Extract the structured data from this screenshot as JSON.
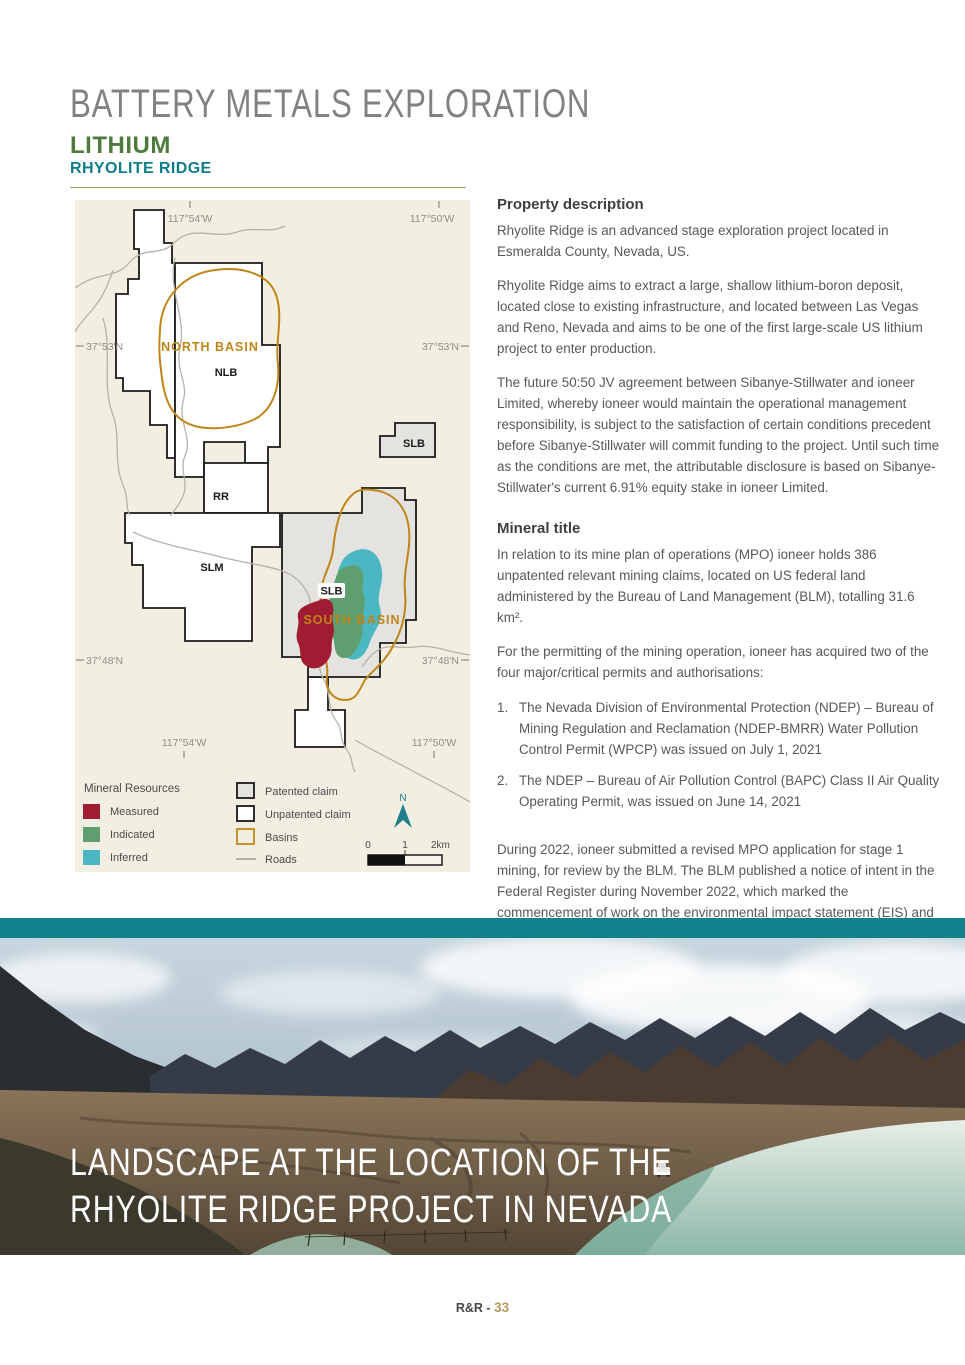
{
  "header": {
    "title": "BATTERY METALS EXPLORATION",
    "commodity": "LITHIUM",
    "project": "RHYOLITE RIDGE"
  },
  "property_description": {
    "heading": "Property description",
    "p1": "Rhyolite Ridge is an advanced stage exploration project located in Esmeralda County, Nevada, US.",
    "p2": "Rhyolite Ridge aims to extract a large, shallow lithium-boron deposit, located close to existing infrastructure, and located between Las Vegas and Reno, Nevada and aims to be one of the first large-scale US lithium project to enter production.",
    "p3": "The future 50:50 JV agreement between Sibanye-Stillwater and ioneer Limited, whereby ioneer would maintain the operational management responsibility, is subject to the satisfaction of certain conditions precedent before Sibanye-Stillwater will commit funding to the project. Until such time as the conditions are met, the attributable disclosure is based on Sibanye-Stillwater's current 6.91% equity stake in ioneer Limited."
  },
  "mineral_title": {
    "heading": "Mineral title",
    "p1": "In relation to its mine plan of operations (MPO) ioneer holds 386 unpatented relevant mining claims, located on US federal land administered by the Bureau of Land Management (BLM), totalling 31.6 km².",
    "p2": "For the permitting of the mining operation, ioneer has acquired two of the four major/critical permits and authorisations:",
    "permits": [
      "The Nevada Division of Environmental Protection (NDEP) – Bureau of Mining Regulation and Reclamation (NDEP-BMRR) Water Pollution Control Permit (WPCP) was issued on July 1, 2021",
      "The NDEP – Bureau of Air Pollution Control (BAPC) Class II Air Quality Operating Permit, was issued on June 14, 2021"
    ],
    "p3": "During 2022, ioneer submitted a revised MPO application for stage 1 mining, for review by the BLM. The BLM published a notice of intent in the Federal Register during November 2022, which marked the commencement of work on the environmental impact statement (EIS) and public engagement process in accordance with the requirements of the National Environmental Policy Act (NEPA). The NEPA process culminates in the BLM's Record of Decision (ROD), which will allow the company to commence construction of the Rhyolite Ridge Project."
  },
  "map": {
    "area_labels": {
      "north_basin": "NORTH BASIN",
      "nlb": "NLB",
      "slb_ne": "SLB",
      "rr": "RR",
      "slm": "SLM",
      "slb_south": "SLB",
      "south_basin": "SOUTH BASIN"
    },
    "coordinates": {
      "lon_west": "117°54'W",
      "lon_east": "117°50'W",
      "lat_north": "37°53'N",
      "lat_south": "37°48'N"
    },
    "legend": {
      "title": "Mineral Resources",
      "measured": "Measured",
      "indicated": "Indicated",
      "inferred": "Inferred",
      "patented": "Patented claim",
      "unpatented": "Unpatented claim",
      "basins": "Basins",
      "roads": "Roads",
      "north": "N",
      "scale_zero": "0",
      "scale_one": "1",
      "scale_two": "2km"
    },
    "colors": {
      "measured": "#A01C33",
      "indicated": "#5F9E6E",
      "inferred": "#4BB7C3",
      "basin": "#C08519",
      "patented_fill": "#E4E3E0",
      "background": "#F2EEE1",
      "north_arrow": "#1D7F8B"
    }
  },
  "photo": {
    "caption_line1": "LANDSCAPE AT THE LOCATION OF THE",
    "caption_line2": "RHYOLITE RIDGE PROJECT IN NEVADA"
  },
  "footer": {
    "report": "R&R -",
    "page": "33"
  }
}
